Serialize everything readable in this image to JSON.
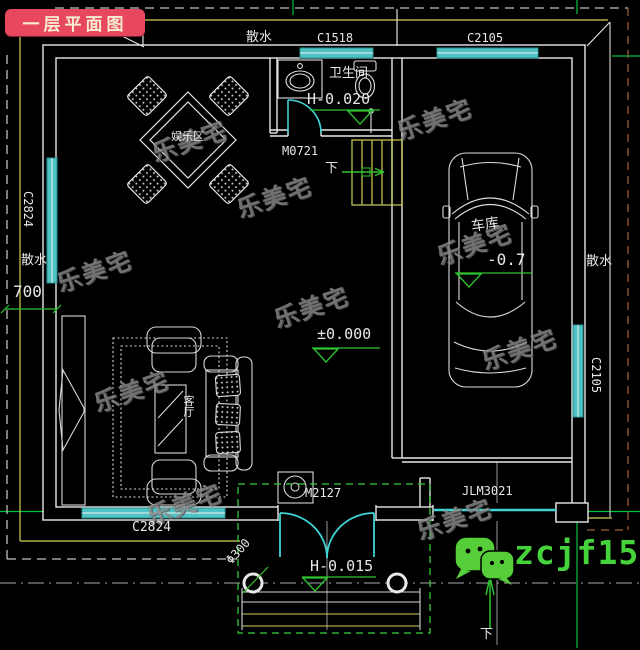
{
  "badge": {
    "label": "一层平面图",
    "bg": "#e8485f",
    "fg": "#f7ecd2"
  },
  "watermark": "乐美宅",
  "contact": {
    "wechat_id": "zcjf159"
  },
  "rooms": {
    "bathroom": "卫生间",
    "garage": "车库",
    "living_room": "客厅",
    "entertainment": "娱乐区"
  },
  "openings": {
    "c1518_top": "C1518",
    "c2105_top": "C2105",
    "c2824_left": "C2824",
    "c2105_right": "C2105",
    "c2824_bottom": "C2824",
    "m0721": "M0721",
    "m2127": "M2127",
    "jlm3021": "JLM3021"
  },
  "annotations": {
    "apron_top": "散水",
    "apron_left": "散水",
    "apron_right": "散水",
    "dim_left": "700",
    "level_bathroom": "H-0.020",
    "level_floor": "±0.000",
    "level_garage": "-0.7",
    "level_porch": "H-0.015",
    "column_diameter": "Φ300",
    "stair_down": "下",
    "slope_down": "下"
  },
  "colors": {
    "background": "#000000",
    "wall_line": "#e8e8e8",
    "window_teal": "#4fc3c3",
    "door_cyan": "#3fd3d3",
    "stair_yellow": "#cfcf55",
    "overhang_yellow": "#d2d25a",
    "annotation_green": "#2fc42f",
    "axis_green": "#00c040",
    "roof_dashed_white": "#c0c0c0",
    "roof_dashed_brown": "#9a6038",
    "watermark_gray": "#8a8a8a",
    "wechat_green": "#45d33c",
    "badge_red": "#e8485f"
  }
}
